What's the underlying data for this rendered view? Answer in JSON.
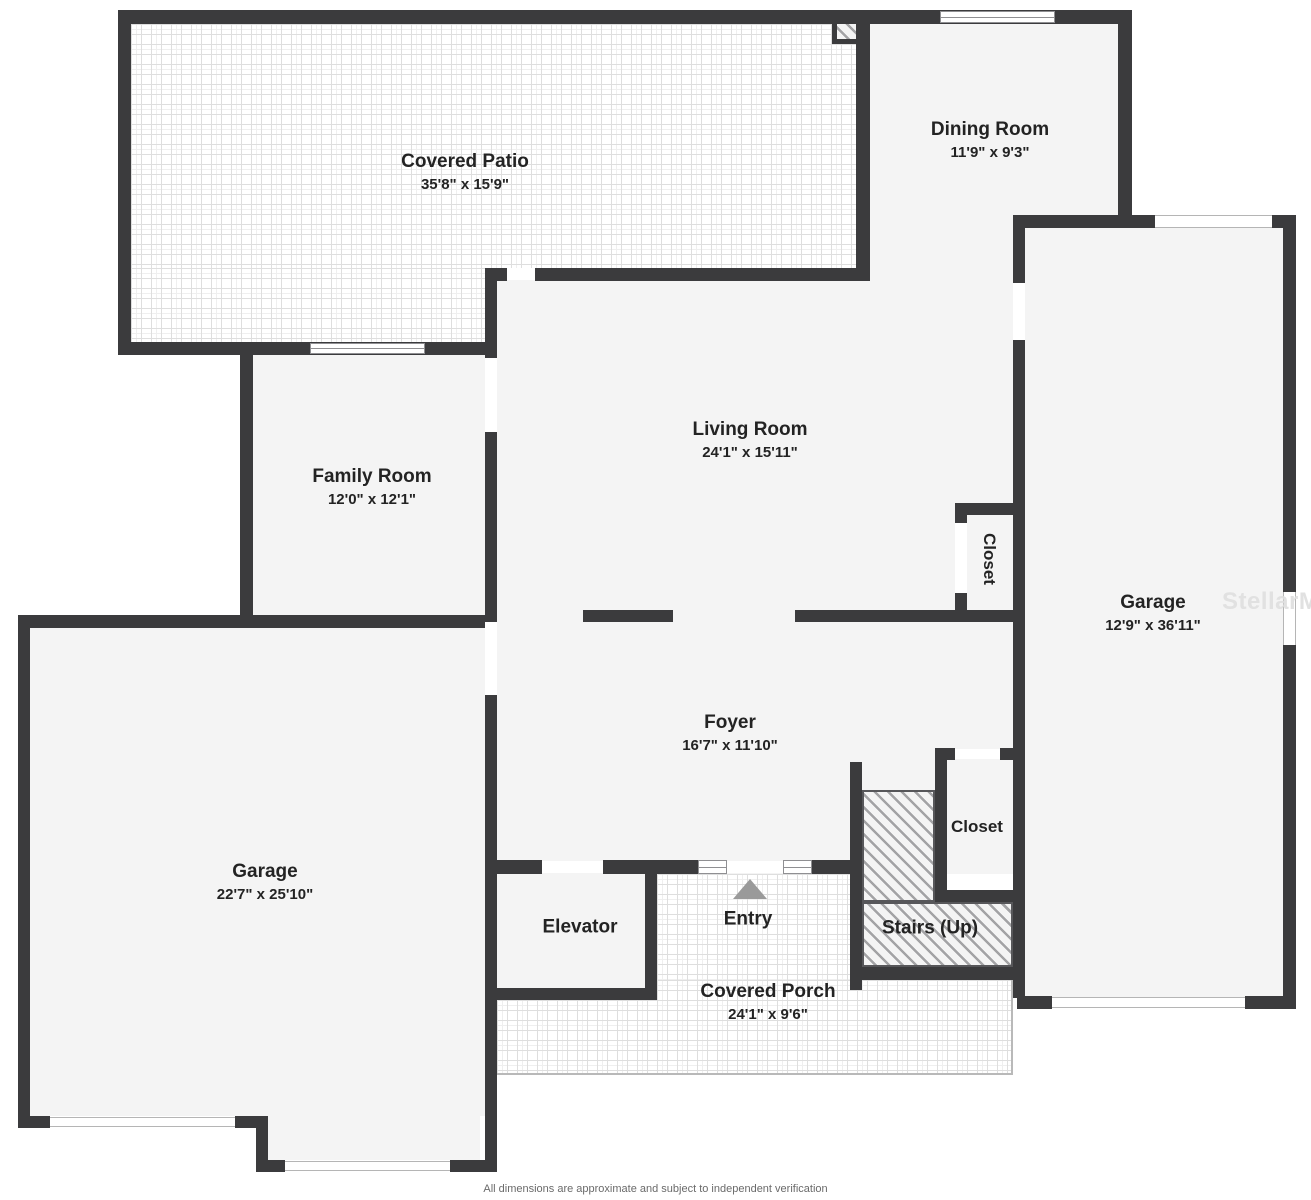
{
  "plan": {
    "disclaimer": "All dimensions are approximate and subject to independent verification",
    "watermark": "StellarMLS"
  },
  "rooms": {
    "covered_patio": {
      "name": "Covered Patio",
      "dims": "35'8\" x 15'9\""
    },
    "dining_room": {
      "name": "Dining Room",
      "dims": "11'9\" x 9'3\""
    },
    "family_room": {
      "name": "Family Room",
      "dims": "12'0\" x 12'1\""
    },
    "living_room": {
      "name": "Living Room",
      "dims": "24'1\" x 15'11\""
    },
    "garage_right": {
      "name": "Garage",
      "dims": "12'9\" x 36'11\""
    },
    "foyer": {
      "name": "Foyer",
      "dims": "16'7\" x 11'10\""
    },
    "garage_left": {
      "name": "Garage",
      "dims": "22'7\" x 25'10\""
    },
    "closet_upper": {
      "name": "Closet"
    },
    "closet_lower": {
      "name": "Closet"
    },
    "elevator": {
      "name": "Elevator"
    },
    "entry": {
      "name": "Entry"
    },
    "stairs": {
      "name": "Stairs (Up)"
    },
    "covered_porch": {
      "name": "Covered Porch",
      "dims": "24'1\" x 9'6\""
    }
  },
  "colors": {
    "wall": "#3b3b3d",
    "floor": "#f4f4f4",
    "label_text": "#232323",
    "entry_arrow": "#9a9a9a",
    "watermark": "#dedede",
    "tile_line": "#dedede",
    "hatch_line": "#a3a3a5"
  }
}
